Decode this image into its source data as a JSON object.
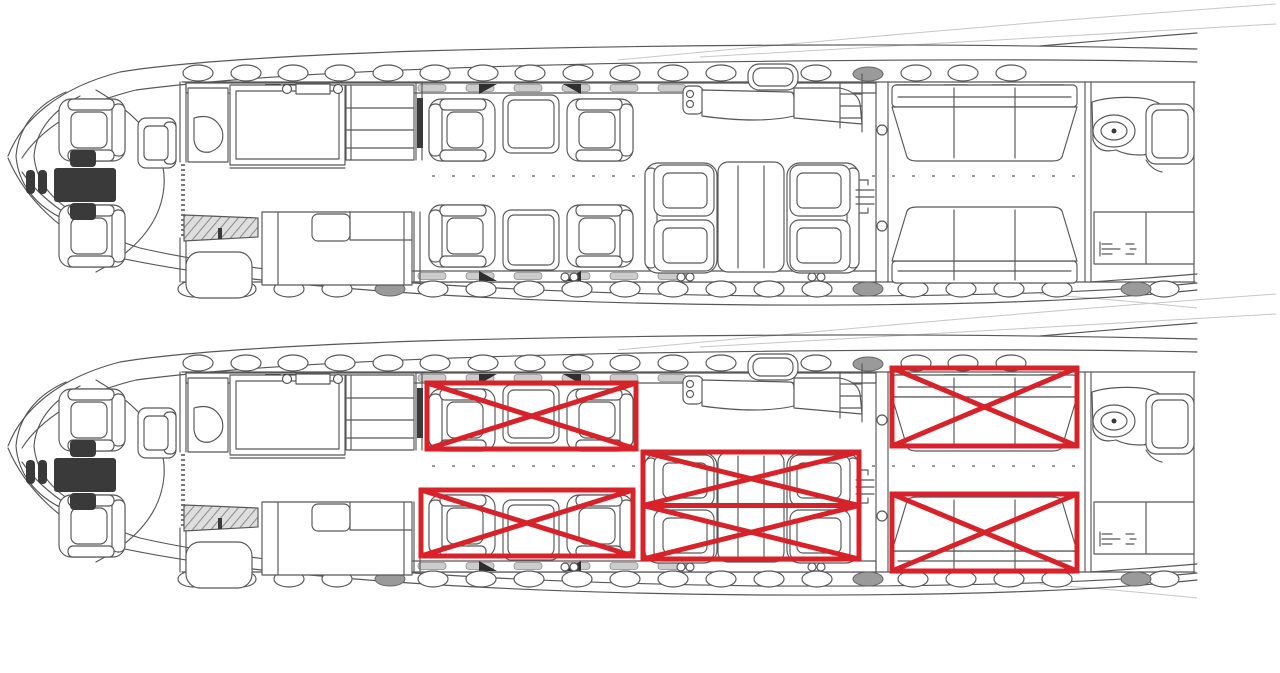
{
  "meta": {
    "description": "Two identical top-view business-jet cabin floor plan line drawings stacked vertically; the lower copy is annotated with five red crossed-out rectangles marking seating zones.",
    "background": "#ffffff"
  },
  "colors": {
    "drawing_line": "#575757",
    "drawing_faint": "#c7c7c7",
    "fill_dark": "#3a3a3a",
    "window_gray": "#9a9a9a",
    "zone_red": "#d8222a"
  },
  "floorplans": [
    {
      "id": "floorplan-original",
      "offset_y": 0,
      "annotated": false
    },
    {
      "id": "floorplan-annotated",
      "offset_y": 290,
      "annotated": true
    }
  ],
  "zone_style": {
    "stroke_width": 5,
    "color": "#d8222a"
  },
  "restricted_zones": [
    {
      "name": "forward-cabin-starboard-club-seats",
      "x": 427,
      "y": 383,
      "width": 209,
      "height": 66,
      "pattern": "x"
    },
    {
      "name": "forward-cabin-port-club-seats",
      "x": 421,
      "y": 490,
      "width": 212,
      "height": 66,
      "pattern": "x"
    },
    {
      "name": "mid-cabin-conference-group",
      "x": 643,
      "y": 452,
      "width": 216,
      "height": 107,
      "pattern": "double-x"
    },
    {
      "name": "aft-cabin-starboard-divan",
      "x": 892,
      "y": 368,
      "width": 185,
      "height": 78,
      "pattern": "x"
    },
    {
      "name": "aft-cabin-port-divan",
      "x": 892,
      "y": 494,
      "width": 185,
      "height": 77,
      "pattern": "x"
    }
  ]
}
